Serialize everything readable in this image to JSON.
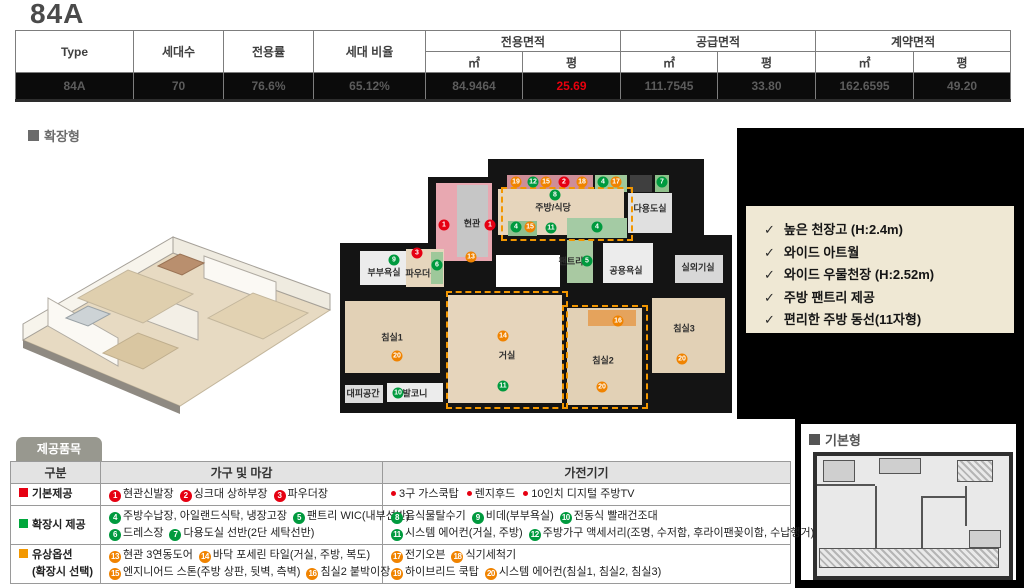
{
  "title": "84A",
  "labels": {
    "expanded": "확장형",
    "basic": "기본형"
  },
  "spec_table": {
    "headers": {
      "type": "Type",
      "units": "세대수",
      "private_ratio": "전용률",
      "unit_ratio": "세대 비율",
      "group_private": "전용면적",
      "group_supply": "공급면적",
      "group_contract": "계약면적",
      "sub_m2": "㎡",
      "sub_py": "평"
    },
    "row": {
      "type": "84A",
      "units": "70",
      "private_ratio": "76.6%",
      "unit_ratio": "65.12%",
      "private_m2": "84.9464",
      "private_py": "25.69",
      "supply_m2": "111.7545",
      "supply_py": "33.80",
      "contract_m2": "162.6595",
      "contract_py": "49.20"
    },
    "highlight_color": "#e8000d"
  },
  "features": [
    "높은 천장고 (H:2.4m)",
    "와이드 아트월",
    "와이드 우물천장 (H:2.52m)",
    "주방 팬트리 제공",
    "편리한 주방 동선(11자형)"
  ],
  "badge_colors": {
    "r": "#e60012",
    "g": "#009a3e",
    "o": "#f08300"
  },
  "floorplan": {
    "walls": [
      [
        148,
        4,
        216,
        96
      ],
      [
        88,
        22,
        68,
        112
      ],
      [
        0,
        88,
        110,
        70
      ],
      [
        0,
        132,
        392,
        126
      ],
      [
        325,
        88,
        67,
        52
      ],
      [
        220,
        80,
        172,
        58
      ]
    ],
    "rooms": [
      {
        "label": "",
        "x": 167,
        "y": 20,
        "w": 86,
        "h": 17,
        "bg": "#ce8e98"
      },
      {
        "label": "",
        "x": 255,
        "y": 20,
        "w": 32,
        "h": 17,
        "bg": "#9ec89a"
      },
      {
        "label": "",
        "x": 290,
        "y": 20,
        "w": 22,
        "h": 17,
        "bg": "#3f3f3f"
      },
      {
        "label": "",
        "x": 315,
        "y": 20,
        "w": 14,
        "h": 17,
        "bg": "#8fc08b"
      },
      {
        "label": "주방/식당",
        "x": 158,
        "y": 34,
        "w": 126,
        "h": 46,
        "bg": "#e6d5bc",
        "lx": 213,
        "ly": 52
      },
      {
        "label": "다용도실",
        "x": 288,
        "y": 38,
        "w": 44,
        "h": 40,
        "bg": "#e0e0e0",
        "lx": 310,
        "ly": 53
      },
      {
        "label": "",
        "x": 96,
        "y": 28,
        "w": 56,
        "h": 78,
        "bg": "#e8a8b1"
      },
      {
        "label": "현관",
        "x": 117,
        "y": 30,
        "w": 31,
        "h": 72,
        "bg": "#c6c6c6",
        "lx": 132,
        "ly": 68
      },
      {
        "label": "",
        "x": 227,
        "y": 63,
        "w": 60,
        "h": 20,
        "bg": "#a4cba4"
      },
      {
        "label": "",
        "x": 168,
        "y": 66,
        "w": 29,
        "h": 15,
        "bg": "#8fbf8f"
      },
      {
        "label": "팬트리",
        "x": 227,
        "y": 85,
        "w": 26,
        "h": 43,
        "bg": "#a9c9a2",
        "lx": 231,
        "ly": 106
      },
      {
        "label": "공용욕실",
        "x": 263,
        "y": 88,
        "w": 50,
        "h": 40,
        "bg": "#ececec",
        "lx": 286,
        "ly": 115
      },
      {
        "label": "실외기실",
        "x": 335,
        "y": 100,
        "w": 48,
        "h": 28,
        "bg": "#d8d8d8",
        "lx": 358,
        "ly": 112
      },
      {
        "label": "부부욕실",
        "x": 20,
        "y": 96,
        "w": 48,
        "h": 34,
        "bg": "#ececec",
        "lx": 44,
        "ly": 117
      },
      {
        "label": "파우더룸",
        "x": 66,
        "y": 94,
        "w": 38,
        "h": 38,
        "bg": "#e6d6bd",
        "lx": 82,
        "ly": 118
      },
      {
        "label": "",
        "x": 91,
        "y": 97,
        "w": 12,
        "h": 32,
        "bg": "#9ec89a"
      },
      {
        "label": "침실1",
        "x": 5,
        "y": 146,
        "w": 95,
        "h": 72,
        "bg": "#e2d1b6",
        "lx": 52,
        "ly": 182
      },
      {
        "label": "거실",
        "x": 108,
        "y": 140,
        "w": 114,
        "h": 108,
        "bg": "#e6d5bc",
        "lx": 167,
        "ly": 200
      },
      {
        "label": "침실2",
        "x": 227,
        "y": 153,
        "w": 75,
        "h": 97,
        "bg": "#e2d1b6",
        "lx": 263,
        "ly": 205
      },
      {
        "label": "",
        "x": 248,
        "y": 155,
        "w": 48,
        "h": 16,
        "bg": "#e5a35c"
      },
      {
        "label": "침실3",
        "x": 312,
        "y": 143,
        "w": 73,
        "h": 75,
        "bg": "#e2d1b6",
        "lx": 344,
        "ly": 173
      },
      {
        "label": "대피공간",
        "x": 5,
        "y": 230,
        "w": 38,
        "h": 18,
        "bg": "#dcdcdc",
        "lx": 23,
        "ly": 238
      },
      {
        "label": "발코니",
        "x": 47,
        "y": 228,
        "w": 56,
        "h": 19,
        "bg": "#ececec",
        "lx": 75,
        "ly": 238
      }
    ],
    "outlines": [
      [
        161,
        32,
        128,
        50
      ],
      [
        106,
        136,
        118,
        114
      ],
      [
        222,
        150,
        82,
        100
      ]
    ],
    "badges": [
      {
        "n": "19",
        "c": "o",
        "x": 176,
        "y": 27
      },
      {
        "n": "12",
        "c": "g",
        "x": 193,
        "y": 27
      },
      {
        "n": "15",
        "c": "o",
        "x": 206,
        "y": 27
      },
      {
        "n": "2",
        "c": "r",
        "x": 224,
        "y": 27
      },
      {
        "n": "18",
        "c": "o",
        "x": 242,
        "y": 27
      },
      {
        "n": "4",
        "c": "g",
        "x": 263,
        "y": 27
      },
      {
        "n": "17",
        "c": "o",
        "x": 276,
        "y": 27
      },
      {
        "n": "7",
        "c": "g",
        "x": 322,
        "y": 27
      },
      {
        "n": "8",
        "c": "g",
        "x": 215,
        "y": 40
      },
      {
        "n": "1",
        "c": "r",
        "x": 104,
        "y": 70
      },
      {
        "n": "1",
        "c": "r",
        "x": 150,
        "y": 70
      },
      {
        "n": "13",
        "c": "o",
        "x": 131,
        "y": 102
      },
      {
        "n": "4",
        "c": "g",
        "x": 176,
        "y": 72
      },
      {
        "n": "15",
        "c": "o",
        "x": 190,
        "y": 72
      },
      {
        "n": "11",
        "c": "g",
        "x": 211,
        "y": 73
      },
      {
        "n": "4",
        "c": "g",
        "x": 257,
        "y": 72
      },
      {
        "n": "5",
        "c": "g",
        "x": 247,
        "y": 106
      },
      {
        "n": "3",
        "c": "r",
        "x": 77,
        "y": 98
      },
      {
        "n": "6",
        "c": "g",
        "x": 97,
        "y": 110
      },
      {
        "n": "9",
        "c": "g",
        "x": 54,
        "y": 105
      },
      {
        "n": "10",
        "c": "g",
        "x": 58,
        "y": 238
      },
      {
        "n": "20",
        "c": "o",
        "x": 57,
        "y": 201
      },
      {
        "n": "14",
        "c": "o",
        "x": 163,
        "y": 181
      },
      {
        "n": "11",
        "c": "g",
        "x": 163,
        "y": 231
      },
      {
        "n": "16",
        "c": "o",
        "x": 278,
        "y": 166
      },
      {
        "n": "20",
        "c": "o",
        "x": 262,
        "y": 232
      },
      {
        "n": "20",
        "c": "o",
        "x": 342,
        "y": 204
      }
    ]
  },
  "items_table": {
    "tab": "제공품목",
    "headers": [
      "구분",
      "가구 및 마감",
      "가전기기"
    ],
    "rows": [
      {
        "category": {
          "color": "#e60012",
          "lines": [
            "기본제공"
          ]
        },
        "furniture": [
          [
            {
              "n": "1",
              "c": "r",
              "t": "현관신발장"
            },
            {
              "n": "2",
              "c": "r",
              "t": "싱크대 상하부장"
            },
            {
              "n": "3",
              "c": "r",
              "t": "파우더장"
            }
          ]
        ],
        "appliance": [
          [
            {
              "n": "dot",
              "c": "r",
              "t": "3구 가스쿡탑"
            },
            {
              "n": "dot",
              "c": "r",
              "t": "렌지후드"
            },
            {
              "n": "dot",
              "c": "r",
              "t": "10인치 디지털 주방TV"
            }
          ]
        ]
      },
      {
        "category": {
          "color": "#00a73c",
          "lines": [
            "확장시 제공"
          ]
        },
        "furniture": [
          [
            {
              "n": "4",
              "c": "g",
              "t": "주방수납장, 아일랜드식탁, 냉장고장"
            },
            {
              "n": "5",
              "c": "g",
              "t": "팬트리 WIC(내부선반)"
            }
          ],
          [
            {
              "n": "6",
              "c": "g",
              "t": "드레스장"
            },
            {
              "n": "7",
              "c": "g",
              "t": "다용도실 선반(2단 세탁선반)"
            }
          ]
        ],
        "appliance": [
          [
            {
              "n": "8",
              "c": "g",
              "t": "음식물탈수기"
            },
            {
              "n": "9",
              "c": "g",
              "t": "비데(부부욕실)"
            },
            {
              "n": "10",
              "c": "g",
              "t": "전동식 빨래건조대"
            }
          ],
          [
            {
              "n": "11",
              "c": "g",
              "t": "시스템 에어컨(거실, 주방)"
            },
            {
              "n": "12",
              "c": "g",
              "t": "주방가구 액세서리(조명, 수저함, 후라이팬꽂이함, 수납행거)"
            }
          ]
        ]
      },
      {
        "category": {
          "color": "#f39800",
          "lines": [
            "유상옵션",
            "(확장시 선택)"
          ]
        },
        "furniture": [
          [
            {
              "n": "13",
              "c": "o",
              "t": "현관 3연동도어"
            },
            {
              "n": "14",
              "c": "o",
              "t": "바닥 포세린 타일(거실, 주방, 복도)"
            }
          ],
          [
            {
              "n": "15",
              "c": "o",
              "t": "엔지니어드 스톤(주방 상판, 뒷벽, 측벽)"
            },
            {
              "n": "16",
              "c": "o",
              "t": "침실2 붙박이장"
            }
          ]
        ],
        "appliance": [
          [
            {
              "n": "17",
              "c": "o",
              "t": "전기오븐"
            },
            {
              "n": "18",
              "c": "o",
              "t": "식기세척기"
            }
          ],
          [
            {
              "n": "19",
              "c": "o",
              "t": "하이브리드 쿡탑"
            },
            {
              "n": "20",
              "c": "o",
              "t": "시스템 에어컨(침실1, 침실2, 침실3)"
            }
          ]
        ]
      }
    ]
  }
}
